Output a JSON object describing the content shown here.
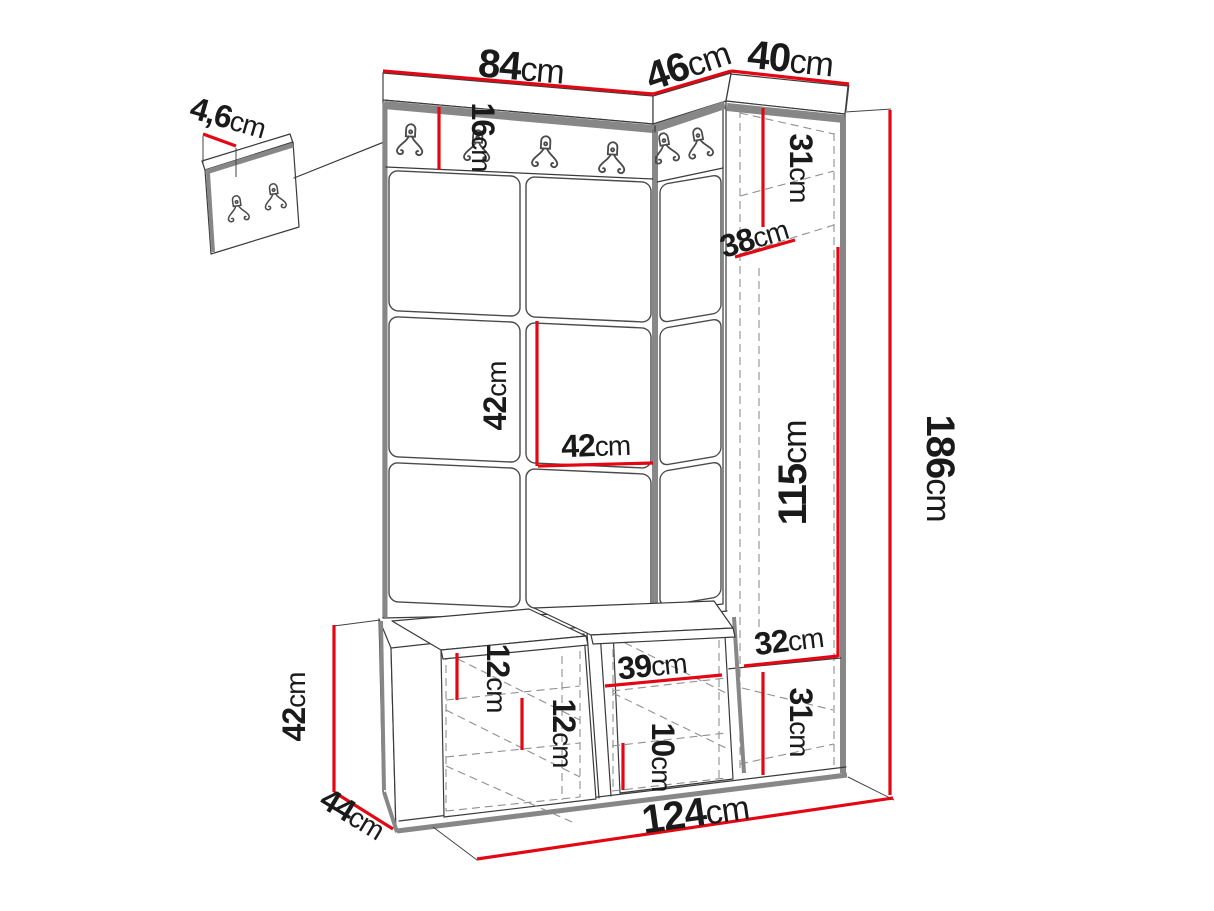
{
  "diagram": {
    "kind": "furniture-dimension-drawing",
    "unit": "cm",
    "colors": {
      "dimension_red": "#e30613",
      "outline_dark": "#3a3a3a",
      "edge_gray": "#878787",
      "hidden_edge_gray": "#8f8f8f",
      "text": "#1a1a1a",
      "background": "#ffffff"
    },
    "icons": {
      "hook": "coat-hook-icon"
    }
  },
  "dims": {
    "d84": {
      "num": "84",
      "unit": "cm"
    },
    "d46": {
      "num": "46",
      "unit": "cm"
    },
    "d40": {
      "num": "40",
      "unit": "cm"
    },
    "d4_6": {
      "num": "4,6",
      "unit": "cm"
    },
    "d16": {
      "num": "16",
      "unit": "cm"
    },
    "d31t": {
      "num": "31",
      "unit": "cm"
    },
    "d38": {
      "num": "38",
      "unit": "cm"
    },
    "d42v": {
      "num": "42",
      "unit": "cm"
    },
    "d42h": {
      "num": "42",
      "unit": "cm"
    },
    "d115": {
      "num": "115",
      "unit": "cm"
    },
    "d186": {
      "num": "186",
      "unit": "cm"
    },
    "d32": {
      "num": "32",
      "unit": "cm"
    },
    "d31b": {
      "num": "31",
      "unit": "cm"
    },
    "d39": {
      "num": "39",
      "unit": "cm"
    },
    "d12a": {
      "num": "12",
      "unit": "cm"
    },
    "d12b": {
      "num": "12",
      "unit": "cm"
    },
    "d10": {
      "num": "10",
      "unit": "cm"
    },
    "d42l": {
      "num": "42",
      "unit": "cm"
    },
    "d44": {
      "num": "44",
      "unit": "cm"
    },
    "d124": {
      "num": "124",
      "unit": "cm"
    }
  }
}
